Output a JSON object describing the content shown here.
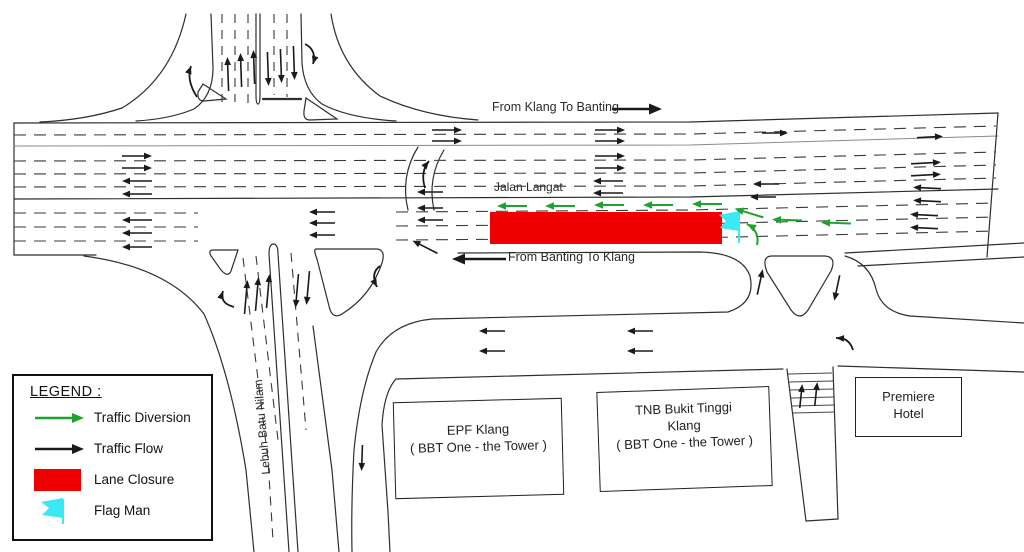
{
  "colors": {
    "traffic_black": "#1a1a1a",
    "diversion_green": "#1fa32e",
    "closure_red": "#ef0000",
    "flagman_cyan": "#3be9f2",
    "road_line": "#2e2e2e"
  },
  "road_labels": {
    "klang_to_banting": "From Klang To Banting",
    "jalan_langat": "Jalan Langat",
    "banting_to_klang": "From Banting To Klang",
    "lebuh_batu_nilam": "Lebuh Batu Nilam"
  },
  "buildings": {
    "epf": {
      "line1": "EPF Klang",
      "line2": "( BBT One - the Tower )"
    },
    "tnb": {
      "line1": "TNB Bukit Tinggi",
      "line2": "Klang",
      "line3": "( BBT One - the Tower )"
    },
    "premiere": {
      "line1": "Premiere",
      "line2": "Hotel"
    }
  },
  "legend": {
    "title": "LEGEND :",
    "items": [
      {
        "symbol": "green-arrow",
        "label": "Traffic Diversion"
      },
      {
        "symbol": "black-arrow",
        "label": "Traffic Flow"
      },
      {
        "symbol": "red-rect",
        "label": "Lane Closure"
      },
      {
        "symbol": "cyan-flag",
        "label": "Flag Man"
      }
    ]
  },
  "closure": {
    "x": 490,
    "y": 212,
    "w": 232,
    "h": 32
  },
  "flagman": {
    "x": 739,
    "y": 212
  },
  "diagram": {
    "straight_arrows": [
      [
        447,
        130,
        0,
        30,
        "k"
      ],
      [
        447,
        141,
        0,
        30,
        "k"
      ],
      [
        610,
        130,
        0,
        30,
        "k"
      ],
      [
        610,
        141,
        0,
        30,
        "k"
      ],
      [
        610,
        156,
        0,
        30,
        "k"
      ],
      [
        610,
        168,
        0,
        30,
        "k"
      ],
      [
        137,
        156,
        0,
        30,
        "k"
      ],
      [
        137,
        168,
        0,
        30,
        "k"
      ],
      [
        775,
        133,
        0,
        26,
        "k"
      ],
      [
        930,
        137,
        -3,
        26,
        "k"
      ],
      [
        926,
        163,
        -3,
        30,
        "k"
      ],
      [
        926,
        175,
        -3,
        30,
        "k"
      ],
      [
        608,
        181,
        180,
        30,
        "k"
      ],
      [
        608,
        193,
        180,
        30,
        "k"
      ],
      [
        137,
        181,
        180,
        30,
        "k"
      ],
      [
        137,
        194,
        180,
        30,
        "k"
      ],
      [
        137,
        220,
        180,
        30,
        "k"
      ],
      [
        137,
        233,
        180,
        30,
        "k"
      ],
      [
        137,
        247,
        180,
        30,
        "k"
      ],
      [
        322,
        212,
        180,
        26,
        "k"
      ],
      [
        322,
        223,
        180,
        26,
        "k"
      ],
      [
        322,
        235,
        180,
        26,
        "k"
      ],
      [
        430,
        192,
        180,
        26,
        "k"
      ],
      [
        430,
        208,
        180,
        26,
        "k"
      ],
      [
        430,
        220,
        180,
        26,
        "k"
      ],
      [
        766,
        184,
        180,
        26,
        "k"
      ],
      [
        763,
        197,
        180,
        26,
        "k"
      ],
      [
        927,
        188,
        183,
        28,
        "k"
      ],
      [
        927,
        201,
        183,
        28,
        "k"
      ],
      [
        924,
        215,
        183,
        28,
        "k"
      ],
      [
        924,
        228,
        183,
        28,
        "k"
      ],
      [
        492,
        331,
        180,
        26,
        "k"
      ],
      [
        492,
        351,
        180,
        26,
        "k"
      ],
      [
        640,
        331,
        180,
        26,
        "k"
      ],
      [
        640,
        351,
        180,
        26,
        "k"
      ],
      [
        228,
        74,
        -92,
        34,
        "k"
      ],
      [
        241,
        70,
        -92,
        34,
        "k"
      ],
      [
        254,
        67,
        -92,
        34,
        "k"
      ],
      [
        268,
        69,
        88,
        34,
        "k"
      ],
      [
        281,
        66,
        88,
        34,
        "k"
      ],
      [
        294,
        63,
        88,
        34,
        "k"
      ],
      [
        246,
        297,
        -85,
        34,
        "k"
      ],
      [
        257,
        294,
        -85,
        34,
        "k"
      ],
      [
        268,
        291,
        -85,
        34,
        "k"
      ],
      [
        297,
        291,
        95,
        34,
        "k"
      ],
      [
        308,
        288,
        95,
        34,
        "k"
      ],
      [
        362,
        458,
        92,
        26,
        "k"
      ],
      [
        801,
        396,
        -84,
        24,
        "k"
      ],
      [
        816,
        394,
        -84,
        24,
        "k"
      ],
      [
        760,
        282,
        -78,
        26,
        "k"
      ],
      [
        837,
        288,
        102,
        26,
        "k"
      ],
      [
        425,
        247,
        207,
        28,
        "k"
      ],
      [
        637,
        109,
        0,
        50,
        "k",
        2.6
      ],
      [
        479,
        259,
        180,
        54,
        "k",
        2.6
      ],
      [
        512,
        206,
        180,
        30,
        "g",
        2
      ],
      [
        560,
        206,
        180,
        30,
        "g",
        2
      ],
      [
        609,
        205,
        180,
        30,
        "g",
        2
      ],
      [
        658,
        205,
        180,
        30,
        "g",
        2
      ],
      [
        707,
        204,
        180,
        30,
        "g",
        2
      ],
      [
        749,
        213,
        197,
        30,
        "g",
        2
      ],
      [
        787,
        220,
        182,
        30,
        "g",
        2
      ],
      [
        836,
        223,
        182,
        30,
        "g",
        2
      ]
    ],
    "curved_arrows": [
      {
        "d": "M197,97 Q186,80 191,66",
        "hx": 191,
        "hy": 66,
        "ha": -70,
        "c": "k"
      },
      {
        "d": "M305,44 Q317,50 313,64",
        "hx": 313,
        "hy": 64,
        "ha": 106,
        "c": "k"
      },
      {
        "d": "M234,307 Q219,303 223,291",
        "hx": 223,
        "hy": 291,
        "ha": -72,
        "c": "k"
      },
      {
        "d": "M380,266 Q370,273 377,287",
        "hx": 377,
        "hy": 287,
        "ha": 63,
        "c": "k"
      },
      {
        "d": "M853,350 Q849,337 836,338",
        "hx": 836,
        "hy": 338,
        "ha": 183,
        "c": "k"
      },
      {
        "d": "M425,188 Q420,172 429,161",
        "hx": 429,
        "hy": 161,
        "ha": -51,
        "c": "k"
      },
      {
        "d": "M757,245 Q760,231 747,224",
        "hx": 747,
        "hy": 224,
        "ha": 208,
        "c": "g",
        "w": 2
      }
    ]
  }
}
